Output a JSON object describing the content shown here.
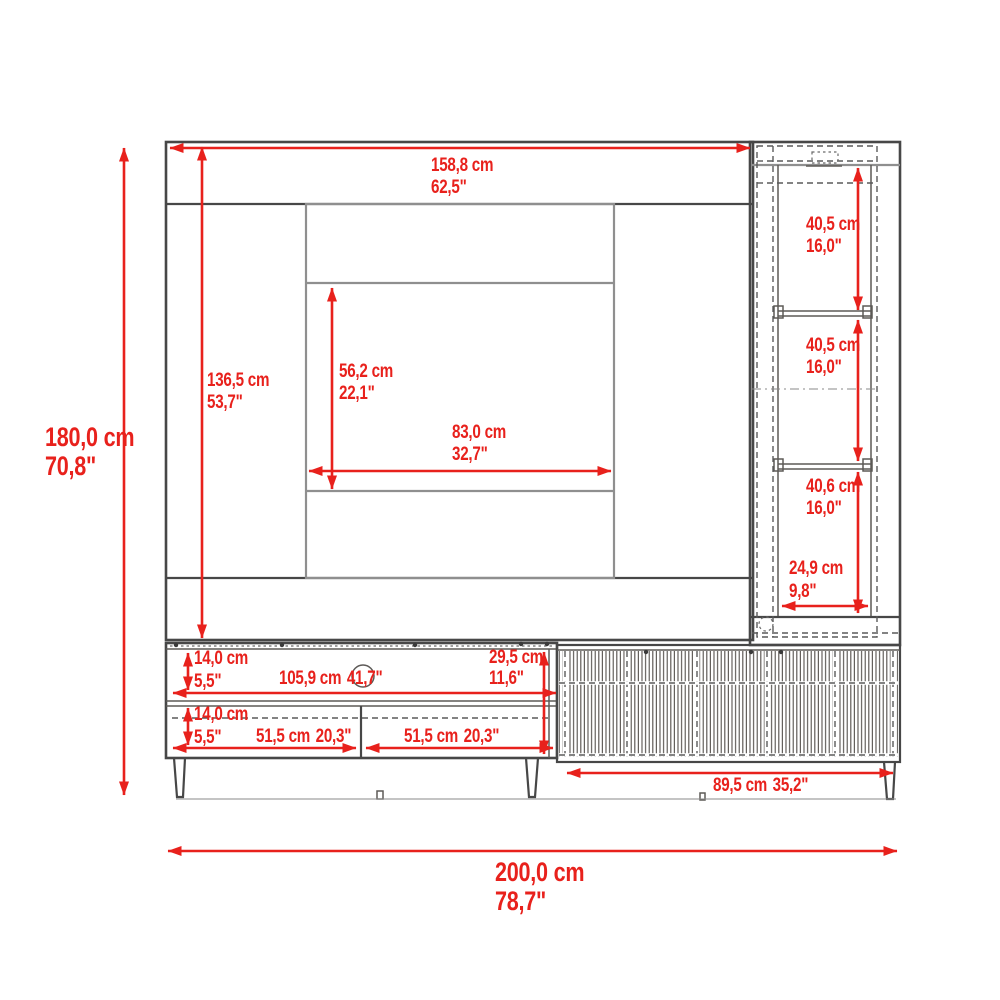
{
  "diagram": {
    "type": "furniture-dimension-drawing",
    "subject": "wall-panel entertainment center with side cabinet and media console",
    "units": [
      "cm",
      "inches"
    ]
  },
  "colors": {
    "dimension_red": "#e8211c",
    "outline_dark": "#474747",
    "outline_gray": "#8f8f8f",
    "background": "#ffffff"
  },
  "dimensions": {
    "overall_height": {
      "cm": "180,0 cm",
      "inches": "70,8\""
    },
    "overall_width": {
      "cm": "200,0 cm",
      "inches": "78,7\""
    },
    "panel_width": {
      "cm": "158,8 cm",
      "inches": "62,5\""
    },
    "panel_height": {
      "cm": "136,5 cm",
      "inches": "53,7\""
    },
    "tv_recess_height": {
      "cm": "56,2 cm",
      "inches": "22,1\""
    },
    "tv_recess_width": {
      "cm": "83,0 cm",
      "inches": "32,7\""
    },
    "side_cabinet_top_section": {
      "cm": "40,5 cm",
      "inches": "16,0\""
    },
    "side_cabinet_middle_section": {
      "cm": "40,5 cm",
      "inches": "16,0\""
    },
    "side_cabinet_bottom_section": {
      "cm": "40,6 cm",
      "inches": "16,0\""
    },
    "side_cabinet_width": {
      "cm": "24,9 cm",
      "inches": "9,8\""
    },
    "console_upper_shelf_height": {
      "cm": "14,0 cm",
      "inches": "5,5\""
    },
    "console_opening_width": {
      "cm": "105,9 cm",
      "inches": "41,7\""
    },
    "console_height": {
      "cm": "29,5 cm",
      "inches": "11,6\""
    },
    "console_lower_shelf_height": {
      "cm": "14,0 cm",
      "inches": "5,5\""
    },
    "console_left_compartment": {
      "cm": "51,5 cm",
      "inches": "20,3\""
    },
    "console_right_compartment": {
      "cm": "51,5 cm",
      "inches": "20,3\""
    },
    "sideboard_doors_width": {
      "cm": "89,5 cm",
      "inches": "35,2\""
    }
  }
}
